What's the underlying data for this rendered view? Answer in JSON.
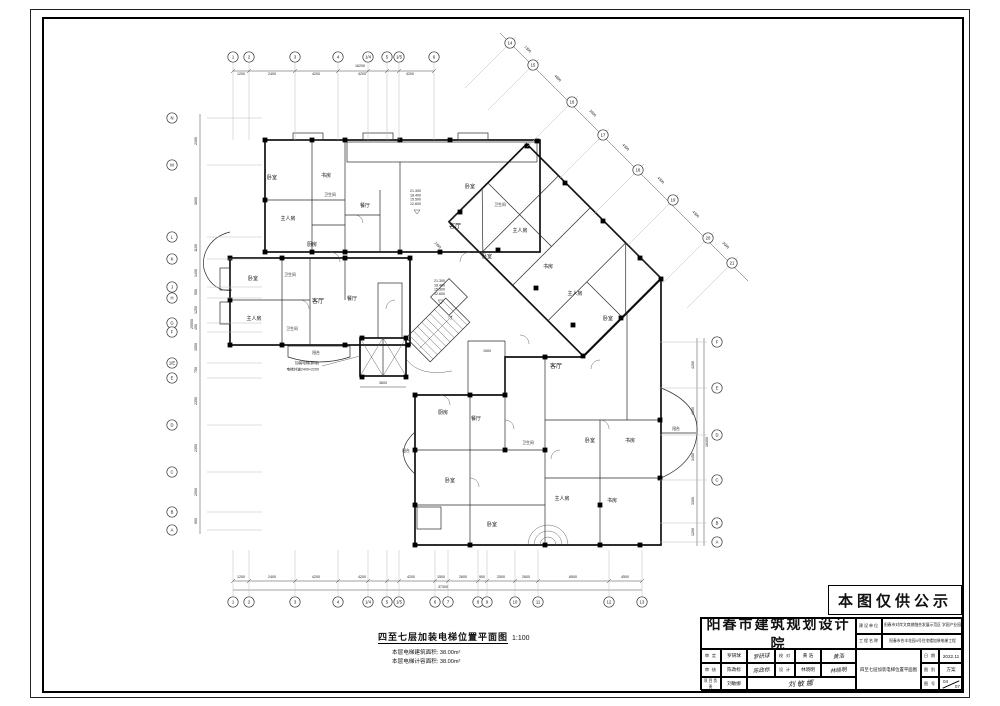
{
  "publicity_note": "本图仅供公示",
  "drawing_caption": {
    "title": "四至七层加装电梯位置平面图",
    "scale": "1:100",
    "notes": [
      "本层电梯建筑面积: 38.00m²",
      "本层电梯计容面积: 38.00m²"
    ]
  },
  "title_block": {
    "institute": "阳春市建筑规划设计院",
    "client_label": "建设单位",
    "client_value": "阳春市对岸文商旅融合发展示范区 学园产业园",
    "project_label": "工程名称",
    "project_value": "阳春市合丰花园4号住宅楼加装电梯工程",
    "approve_label": "审 定",
    "approve_name": "罗研球",
    "approve_sign": "罗研球",
    "check_label": "审 核",
    "check_name": "陈政标",
    "check_sign": "陈政标",
    "lead_label": "项目负责",
    "lead_name": "刘敏娜",
    "lead_sign": "刘敏娜",
    "proof_label": "校 对",
    "proof_name": "黄 浩",
    "proof_sign": "黄浩",
    "design_label": "设 计",
    "design_name": "林晓明",
    "design_sign": "林晓明",
    "drawing_name": "四至七层加装电梯位置平面图",
    "date_label": "日 期",
    "date_value": "2022.11",
    "type_label": "图 别",
    "type_value": "方案",
    "no_label": "图 号",
    "no_top": "04",
    "no_bottom": "07"
  },
  "plan": {
    "elevator_note": [
      "加装电梯(新增)",
      "电梯井道2400×2200"
    ],
    "elevations": [
      "21.300",
      "18.400",
      "15.500",
      "12.600"
    ],
    "elevation_marks": [
      {
        "x": 410,
        "y": 192
      },
      {
        "x": 434,
        "y": 282
      }
    ],
    "small_dims": [
      {
        "v": "3600",
        "x": 383,
        "y": 384
      },
      {
        "v": "2350",
        "x": 437,
        "y": 246,
        "r": 45
      },
      {
        "v": "1500",
        "x": 487,
        "y": 352
      }
    ],
    "rooms": [
      {
        "t": "卧室",
        "x": 272,
        "y": 179
      },
      {
        "t": "书房",
        "x": 326,
        "y": 177
      },
      {
        "t": "卫生间",
        "x": 330,
        "y": 196,
        "s": 3.8
      },
      {
        "t": "主人房",
        "x": 288,
        "y": 220
      },
      {
        "t": "餐厅",
        "x": 365,
        "y": 207
      },
      {
        "t": "厨房",
        "x": 312,
        "y": 246
      },
      {
        "t": "客厅",
        "x": 455,
        "y": 228,
        "s": 6
      },
      {
        "t": "卧室",
        "x": 470,
        "y": 188
      },
      {
        "t": "卫生间",
        "x": 500,
        "y": 206,
        "s": 3.8
      },
      {
        "t": "主人房",
        "x": 520,
        "y": 232
      },
      {
        "t": "卧室",
        "x": 487,
        "y": 258
      },
      {
        "t": "书房",
        "x": 548,
        "y": 268
      },
      {
        "t": "主人房",
        "x": 575,
        "y": 295
      },
      {
        "t": "卧室",
        "x": 608,
        "y": 320
      },
      {
        "t": "卧室",
        "x": 253,
        "y": 280
      },
      {
        "t": "卫生间",
        "x": 290,
        "y": 276,
        "s": 3.8
      },
      {
        "t": "主人房",
        "x": 254,
        "y": 320
      },
      {
        "t": "卫生间",
        "x": 292,
        "y": 330,
        "s": 3.8
      },
      {
        "t": "客厅",
        "x": 318,
        "y": 303,
        "s": 6
      },
      {
        "t": "餐厅",
        "x": 352,
        "y": 300
      },
      {
        "t": "阳台",
        "x": 316,
        "y": 354,
        "s": 3.8
      },
      {
        "t": "客厅",
        "x": 556,
        "y": 368,
        "s": 6
      },
      {
        "t": "厨房",
        "x": 443,
        "y": 414
      },
      {
        "t": "餐厅",
        "x": 476,
        "y": 420
      },
      {
        "t": "卫生间",
        "x": 528,
        "y": 444,
        "s": 3.8
      },
      {
        "t": "卧室",
        "x": 590,
        "y": 442
      },
      {
        "t": "书房",
        "x": 630,
        "y": 442
      },
      {
        "t": "卧室",
        "x": 450,
        "y": 482
      },
      {
        "t": "主人房",
        "x": 562,
        "y": 500
      },
      {
        "t": "书房",
        "x": 612,
        "y": 502
      },
      {
        "t": "卧室",
        "x": 492,
        "y": 526
      },
      {
        "t": "阳台",
        "x": 676,
        "y": 430,
        "s": 3.8
      },
      {
        "t": "阳台",
        "x": 406,
        "y": 452,
        "s": 3.8
      }
    ],
    "columns": [
      [
        265,
        140
      ],
      [
        312,
        140
      ],
      [
        345,
        140
      ],
      [
        400,
        140
      ],
      [
        450,
        140
      ],
      [
        537,
        141
      ],
      [
        265,
        200
      ],
      [
        265,
        252
      ],
      [
        312,
        252
      ],
      [
        345,
        252
      ],
      [
        400,
        252
      ],
      [
        440,
        252
      ],
      [
        230,
        258
      ],
      [
        282,
        258
      ],
      [
        345,
        258
      ],
      [
        410,
        258
      ],
      [
        230,
        300
      ],
      [
        230,
        345
      ],
      [
        282,
        345
      ],
      [
        345,
        345
      ],
      [
        408,
        345
      ],
      [
        362,
        338
      ],
      [
        406,
        338
      ],
      [
        362,
        377
      ],
      [
        406,
        377
      ],
      [
        460,
        212
      ],
      [
        498,
        250
      ],
      [
        536,
        288
      ],
      [
        573,
        325
      ],
      [
        527,
        146
      ],
      [
        565,
        183
      ],
      [
        603,
        221
      ],
      [
        640,
        258
      ],
      [
        583,
        356
      ],
      [
        621,
        318
      ],
      [
        415,
        395
      ],
      [
        470,
        395
      ],
      [
        505,
        395
      ],
      [
        545,
        357
      ],
      [
        661,
        279
      ],
      [
        660,
        420
      ],
      [
        660,
        478
      ],
      [
        415,
        450
      ],
      [
        415,
        505
      ],
      [
        415,
        545
      ],
      [
        470,
        545
      ],
      [
        545,
        545
      ],
      [
        600,
        545
      ],
      [
        640,
        545
      ],
      [
        505,
        450
      ],
      [
        545,
        450
      ],
      [
        600,
        505
      ]
    ],
    "grids": {
      "top": {
        "cy": 57,
        "line": [
          63,
          140
        ],
        "dimy": 75,
        "ticky": 71,
        "bubbles": [
          {
            "l": "1",
            "p": 233
          },
          {
            "l": "2",
            "p": 249
          },
          {
            "l": "3",
            "p": 295
          },
          {
            "l": "4",
            "p": 338
          },
          {
            "l": "1/4",
            "p": 368
          },
          {
            "l": "5",
            "p": 387
          },
          {
            "l": "1/5",
            "p": 399
          },
          {
            "l": "6",
            "p": 434
          }
        ],
        "dims": [
          {
            "v": "1200",
            "p": 241
          },
          {
            "v": "2400",
            "p": 272
          },
          {
            "v": "4200",
            "p": 316
          },
          {
            "v": "4200",
            "p": 362
          },
          {
            "v": "4200",
            "p": 410
          }
        ]
      },
      "bottom": {
        "cy": 602,
        "line": [
          550,
          596
        ],
        "dimy": 578,
        "ticky": 581,
        "bubbles": [
          {
            "l": "1",
            "p": 233
          },
          {
            "l": "2",
            "p": 249
          },
          {
            "l": "3",
            "p": 295
          },
          {
            "l": "4",
            "p": 338
          },
          {
            "l": "1/4",
            "p": 368
          },
          {
            "l": "5",
            "p": 387
          },
          {
            "l": "1/5",
            "p": 399
          },
          {
            "l": "6",
            "p": 435
          },
          {
            "l": "7",
            "p": 448
          },
          {
            "l": "8",
            "p": 478
          },
          {
            "l": "9",
            "p": 487
          },
          {
            "l": "10",
            "p": 515
          },
          {
            "l": "11",
            "p": 538
          },
          {
            "l": "12",
            "p": 609
          },
          {
            "l": "13",
            "p": 642
          }
        ],
        "dims": [
          {
            "v": "1200",
            "p": 241
          },
          {
            "v": "2400",
            "p": 272
          },
          {
            "v": "4200",
            "p": 316
          },
          {
            "v": "4200",
            "p": 362
          },
          {
            "v": "4200",
            "p": 411
          },
          {
            "v": "1500",
            "p": 441
          },
          {
            "v": "2600",
            "p": 463
          },
          {
            "v": "900",
            "p": 482
          },
          {
            "v": "2500",
            "p": 501
          },
          {
            "v": "2600",
            "p": 526
          },
          {
            "v": "6500",
            "p": 573
          },
          {
            "v": "4500",
            "p": 625
          }
        ]
      },
      "left": {
        "cx": 172,
        "line": [
          207,
          262
        ],
        "dimx": 197,
        "bubbles": [
          {
            "l": "N",
            "p": 118
          },
          {
            "l": "M",
            "p": 165
          },
          {
            "l": "L",
            "p": 237
          },
          {
            "l": "K",
            "p": 259
          },
          {
            "l": "J",
            "p": 287
          },
          {
            "l": "H",
            "p": 298
          },
          {
            "l": "G",
            "p": 323
          },
          {
            "l": "F",
            "p": 332
          },
          {
            "l": "1/E",
            "p": 363
          },
          {
            "l": "E",
            "p": 378
          },
          {
            "l": "D",
            "p": 425
          },
          {
            "l": "C",
            "p": 472
          },
          {
            "l": "B",
            "p": 512
          },
          {
            "l": "A",
            "p": 530
          }
        ],
        "dims": [
          {
            "v": "2300",
            "p": 141
          },
          {
            "v": "3600",
            "p": 201
          },
          {
            "v": "1100",
            "p": 248
          },
          {
            "v": "1400",
            "p": 273
          },
          {
            "v": "550",
            "p": 292
          },
          {
            "v": "1250",
            "p": 310
          },
          {
            "v": "450",
            "p": 327
          },
          {
            "v": "1550",
            "p": 347
          },
          {
            "v": "750",
            "p": 370
          },
          {
            "v": "2350",
            "p": 401
          },
          {
            "v": "2350",
            "p": 448
          },
          {
            "v": "2000",
            "p": 492
          },
          {
            "v": "900",
            "p": 521
          }
        ]
      },
      "right": {
        "cx": 717,
        "line": [
          660,
          707
        ],
        "dimx": 694,
        "bubbles": [
          {
            "l": "F",
            "p": 342
          },
          {
            "l": "E",
            "p": 388
          },
          {
            "l": "D",
            "p": 435
          },
          {
            "l": "C",
            "p": 480
          },
          {
            "l": "B",
            "p": 523
          },
          {
            "l": "A",
            "p": 542
          }
        ],
        "dims": [
          {
            "v": "4200",
            "p": 365
          },
          {
            "v": "4150",
            "p": 411
          },
          {
            "v": "3450",
            "p": 457
          },
          {
            "v": "3300",
            "p": 501
          },
          {
            "v": "1200",
            "p": 532
          }
        ]
      },
      "diag": {
        "bubbles": [
          {
            "l": "14",
            "x": 510,
            "y": 43
          },
          {
            "l": "15",
            "x": 533,
            "y": 65
          },
          {
            "l": "16",
            "x": 572,
            "y": 102
          },
          {
            "l": "17",
            "x": 603,
            "y": 135
          },
          {
            "l": "18",
            "x": 638,
            "y": 170
          },
          {
            "l": "19",
            "x": 673,
            "y": 200
          },
          {
            "l": "20",
            "x": 708,
            "y": 238
          },
          {
            "l": "21",
            "x": 732,
            "y": 263
          }
        ],
        "dims": [
          {
            "v": "1300",
            "x": 527,
            "y": 50
          },
          {
            "v": "4800",
            "x": 557,
            "y": 79
          },
          {
            "v": "3900",
            "x": 592,
            "y": 114
          },
          {
            "v": "4300",
            "x": 625,
            "y": 148
          },
          {
            "v": "4300",
            "x": 660,
            "y": 181
          },
          {
            "v": "4300",
            "x": 695,
            "y": 215
          },
          {
            "v": "3000",
            "x": 725,
            "y": 246
          }
        ]
      }
    },
    "totals": [
      {
        "v": "16200",
        "x": 360,
        "y": 67
      },
      {
        "v": "37300",
        "x": 443,
        "y": 588
      },
      {
        "v": "20550",
        "x": 193,
        "y": 324,
        "r": -90
      },
      {
        "v": "16300",
        "x": 708,
        "y": 442,
        "r": -90
      }
    ]
  }
}
